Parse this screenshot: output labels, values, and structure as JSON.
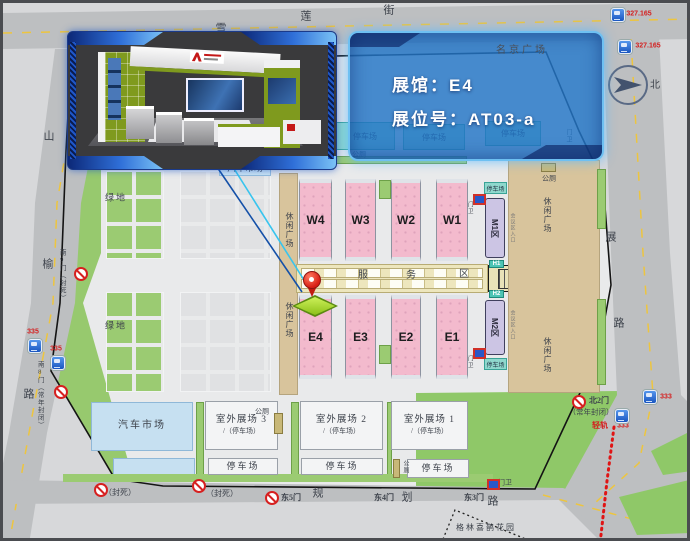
{
  "callout": {
    "line1": "展馆：E4",
    "line2": "展位号：AT03-a"
  },
  "compass": {
    "north": "北"
  },
  "streets": {
    "top": [
      "雪",
      "莲",
      "街"
    ],
    "left": [
      "山",
      "榆",
      "路"
    ],
    "right": [
      "展",
      "路"
    ],
    "bottom": [
      "规",
      "划",
      "路"
    ]
  },
  "gates": {
    "south9": "南9门（封死）",
    "south8": "南8门（常年封闭）",
    "sealed": "（封死）",
    "east5": "东5门",
    "east4": "东4门",
    "east3": "东3门",
    "north2": "北2门",
    "north2_note": "（常年封闭）",
    "guard": "门卫"
  },
  "transit": {
    "bus_327": "327.165",
    "bus_335": "335",
    "bus_333": "333",
    "light_rail": "轻轨"
  },
  "halls": {
    "w": [
      "W4",
      "W3",
      "W2",
      "W1"
    ],
    "e": [
      "E4",
      "E3",
      "E2",
      "E1"
    ],
    "m1": "M1区",
    "m2": "M2区",
    "h1": "H1",
    "h2": "H2",
    "meeting_entrance": "会议区入口"
  },
  "areas": {
    "green": "绿地",
    "auto_market": "汽车市场",
    "leisure": "休闲广场",
    "mingjing": "名京广场",
    "service": [
      "服",
      "务",
      "区"
    ],
    "parking": "停车场",
    "toilet": "公厕",
    "outdoor3": "室外展场 3",
    "outdoor2": "室外展场 2",
    "outdoor1": "室外展场 1",
    "outdoor_sub": "/（停车场）",
    "garden": "格林喜鹊花园"
  },
  "colors": {
    "accent_blue": "#2a86d6",
    "hall_pink": "#f3bacd",
    "green": "#97c96e",
    "route_red": "#d42020"
  }
}
